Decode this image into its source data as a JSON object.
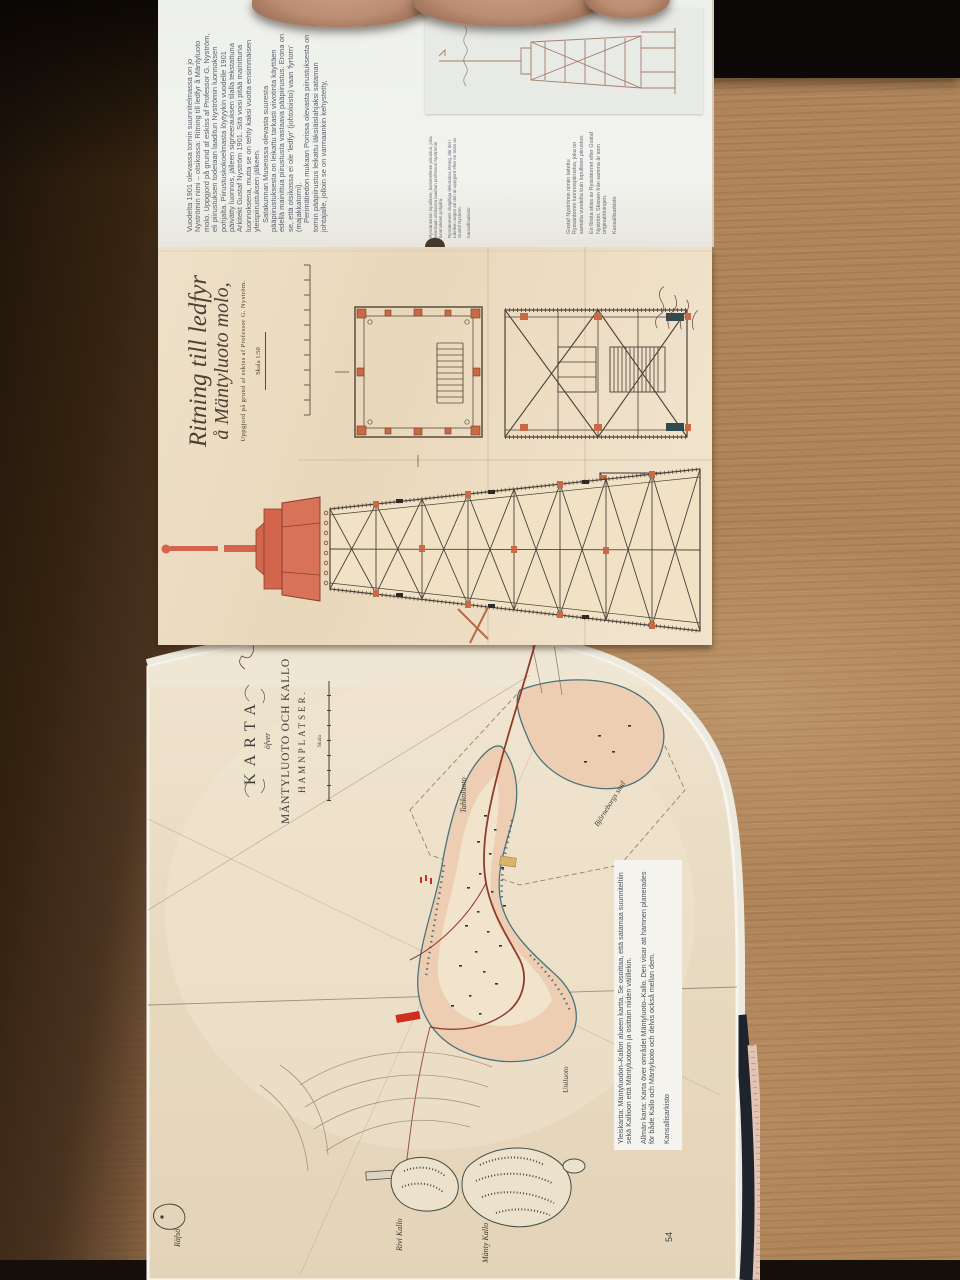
{
  "foldout": {
    "article": {
      "p1": "Vuodelta 1901 olevassa tornin suunnitelmassa on jo Nyströmin nimi – otsikossa: Ritning till ledfyr å Mäntyluoto molo. Uppgjord på grund af eskiss af Professor G. Nyström, eli piirustuksen todetaan laaditun Nyströmin luonnoksen pohjalta. Piirustuskokoelmasta löytyykin vuodelle 1901 päivätty luonnos, jälleen signeerauksen tilalla tekstattuna Arkitekt Gustaf Nyström 1901. Sitä voisi pitää mainittuna luonnoksena, mutta se on tehty kaksi vuotta ensimmäisen yleispiirustuksen jälkeen.",
      "p2": "Satakunnan Museossa olevasta suuresta pääpiirustuksesta on leikattu tarkasti viivotinta käyttäen edellä mainittua piirustusta vastaava pääpiirustus. Erona on se, että otsikossa ei ole 'ledfyr' (johtoloisto) vaan 'fyrtorn' (majakkatorni).",
      "p3": "Perimätiedon mukaan Porissa olevasta piirustuksesta on tornin pääpiirustus leikattu läksiäislahjaksi sataman johtajalle, jolloin se on varmaankin kehystetty,"
    },
    "caption1": {
      "fi": "Ryssäntornin lopullinen, koristeellinen piirustus, joka kerrotaan otsikossa laaditun professori Nyströmin luonnoksen pohjalta.",
      "sv": "Ryssätornets slutgiltiga dekorativa ritning, där det i rubriken anges att den är uppgjord efter en skiss av Gustaf Nyström.",
      "source": "Kansallisarkisto"
    },
    "caption2": {
      "fi": "Gustaf Nyströmin nimiin laitettu Ryssäntornin luonnospiirustus, joka on samalta vuodelta kuin lopullinen piirustus.",
      "sv": "En första skiss av Ryssätornet efter Gustaf Nyström. Skissen från samma år som originalritningen.",
      "source": "Kansallisarkisto"
    },
    "drawing": {
      "title1": "Ritning till ledfyr",
      "title2": "å Mäntyluoto molo,",
      "subtitle": "Uppgjord på grund af eskiss af Professor G. Nyström.",
      "scale": "Skala 1:50"
    }
  },
  "map": {
    "title": {
      "karta": "KARTA",
      "ofver": "öfver",
      "line1": "MÄNTYLUOTO OCH KALLO",
      "line2": "HAMNPLATSER.",
      "scale": "Skala"
    },
    "labels": {
      "tahkoluoto": "Tahkoluoto",
      "bjorneborg": "Björneborgs stad",
      "uniluoto": "Uniluoto",
      "manty_kallo": "Mänty Kallo",
      "rivi_kallo": "Rivi Kallo",
      "rafso": "Räfsö"
    },
    "caption": {
      "fi": "Yleiskartta: Mäntyluodon–Kallon alueen kartta. Se osoittaa, että satamaa suunniteltiin sekä Kallioon että Mäntyluotoon ja osittain niiden välillekin.",
      "sv": "Allmän karta: Karta över området Mäntyluoto–Kallo. Den visar att hamnen planerades för både Kallo och Mäntyluoto och delvis också mellan dem.",
      "source": "Kansallisarkisto"
    },
    "page_number": "54"
  },
  "colors": {
    "wood": "#b0855a",
    "wood_shadow": "#33220f",
    "page_white": "#eef0ec",
    "page_aged": "#ead9bf",
    "ink": "#4a4238",
    "accent_red": "#c96a45",
    "lantern_red": "#d2654c",
    "map_land": "#eeceb2",
    "shore_teal": "#4b737c",
    "railway_red": "#8e3b2c",
    "cover_navy": "#1f242c"
  }
}
